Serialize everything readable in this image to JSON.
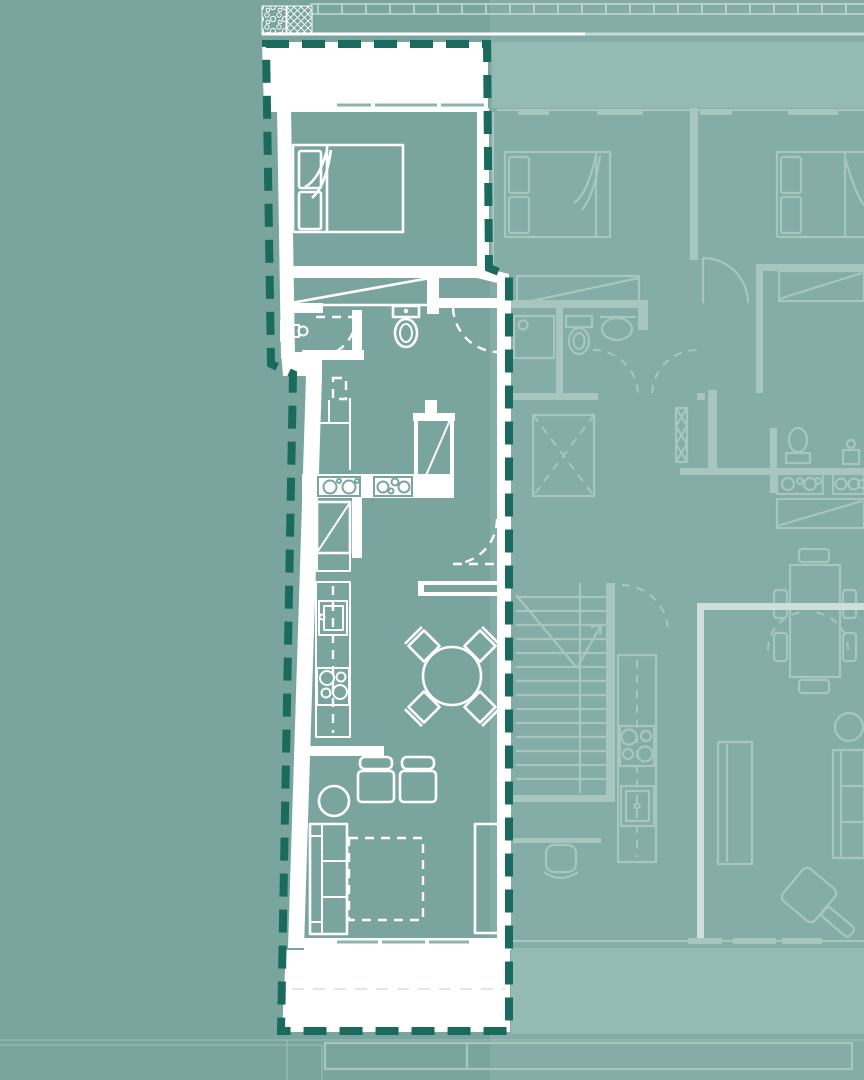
{
  "meta": {
    "type": "architectural-floor-plan",
    "description": "Site plan with one apartment unit highlighted by a dark dashed boundary over a teal background; adjacent units drawn in faint lines"
  },
  "colors": {
    "background": "#7aa59f",
    "background_right": "#83ada6",
    "terrace_tint": "#93bbb4",
    "unit_wall": "#ffffff",
    "unit_line": "#ffffff",
    "boundary_dash": "#1a6a5e",
    "neighbor_line": "#a7c6c0",
    "party_wall": "#cfe0dc",
    "window_tick": "#8cb4ad",
    "terrace_divider": "#dfe9e7"
  },
  "selected_unit": {
    "highlighted": true,
    "boundary_style": "dashed",
    "areas": [
      "terrace-top",
      "bedroom",
      "bathroom",
      "storage",
      "kitchen",
      "dining",
      "living",
      "terrace-bottom"
    ],
    "furniture_icons": [
      "double-bed-icon",
      "wardrobe-icon",
      "toilet-icon",
      "washbasin-icon",
      "appliance-icon",
      "tall-cabinet-icon",
      "kitchen-counter-icon",
      "kitchen-sink-icon",
      "hob-icon",
      "round-dining-table-icon",
      "dining-chair-icon",
      "armchair-icon",
      "side-table-icon",
      "sofa-icon",
      "rug-icon",
      "sideboard-icon"
    ]
  },
  "adjacent_units": {
    "furniture_icons": [
      "double-bed-icon",
      "wardrobe-icon",
      "shower-icon",
      "toilet-icon",
      "washbasin-icon",
      "elevator-icon",
      "staircase-icon",
      "kitchen-counter-icon",
      "hob-icon",
      "kitchen-sink-icon",
      "dining-table-icon",
      "dining-chair-icon",
      "desk-chair-icon",
      "sofa-icon",
      "sideboard-icon",
      "round-table-icon",
      "armchair-icon",
      "ottoman-icon"
    ]
  }
}
